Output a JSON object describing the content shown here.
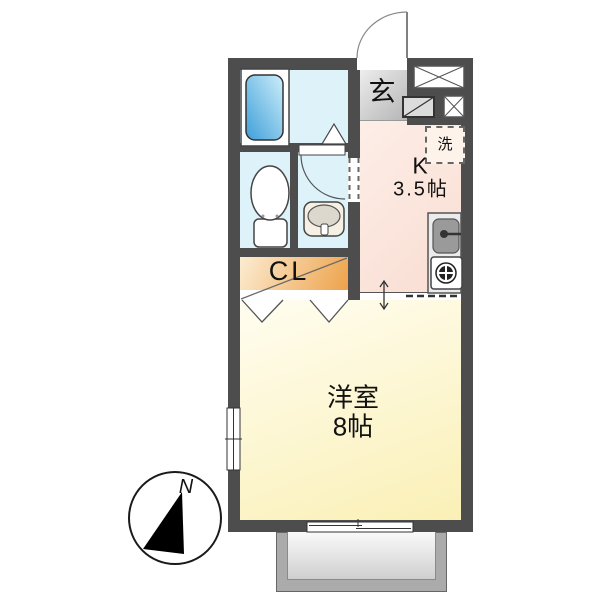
{
  "plan": {
    "entrance": {
      "label": "玄"
    },
    "kitchen": {
      "label": "K",
      "size": "3.5帖"
    },
    "laundry": {
      "label": "洗"
    },
    "closet": {
      "label": "CL"
    },
    "western_room": {
      "label": "洋室",
      "size": "8帖"
    },
    "compass": {
      "north": "N"
    }
  },
  "colors": {
    "wall": "#4d4d4d",
    "sanitary_rooms": "#def3f9",
    "kitchen": "#fce5dc",
    "entrance_gradient_top": "#f0f0f0",
    "entrance_gradient_bottom": "#b5b5b5",
    "closet_gradient_top": "#fcecd2",
    "closet_gradient_bottom": "#eda24a",
    "western_room_top": "#fffdf0",
    "western_room_bottom": "#faf0b6",
    "bathtub_top": "#cdeefa",
    "bathtub_bottom": "#3e9fd9",
    "balcony_frame": "#ababab"
  }
}
